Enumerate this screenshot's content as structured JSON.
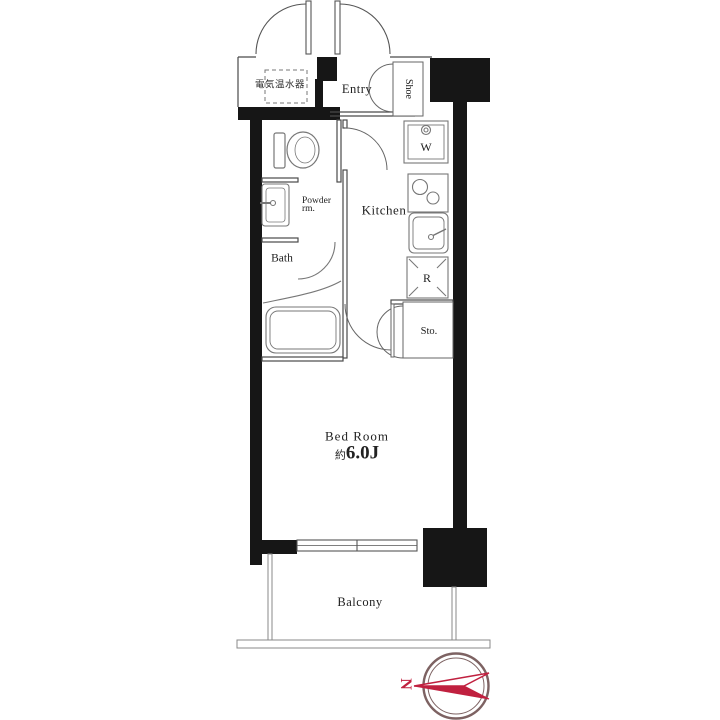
{
  "labels": {
    "water_heater": "電気温水器",
    "entry": "Entry",
    "shoe": "Shoe",
    "washer": "W",
    "kitchen": "Kitchen",
    "powder_room_line1": "Powder",
    "powder_room_line2": "rm.",
    "bath": "Bath",
    "refrigerator": "R",
    "storage": "Sto.",
    "bedroom": "Bed Room",
    "bedroom_size_prefix": "約",
    "bedroom_size": "6.0J",
    "balcony": "Balcony",
    "compass_north": "N"
  },
  "colors": {
    "background": "#ffffff",
    "wall_fill": "#161616",
    "thin_line": "#4a4a4a",
    "fixture_line": "#777777",
    "compass_ring": "#7d6262",
    "compass_arrow": "#c0203f"
  }
}
